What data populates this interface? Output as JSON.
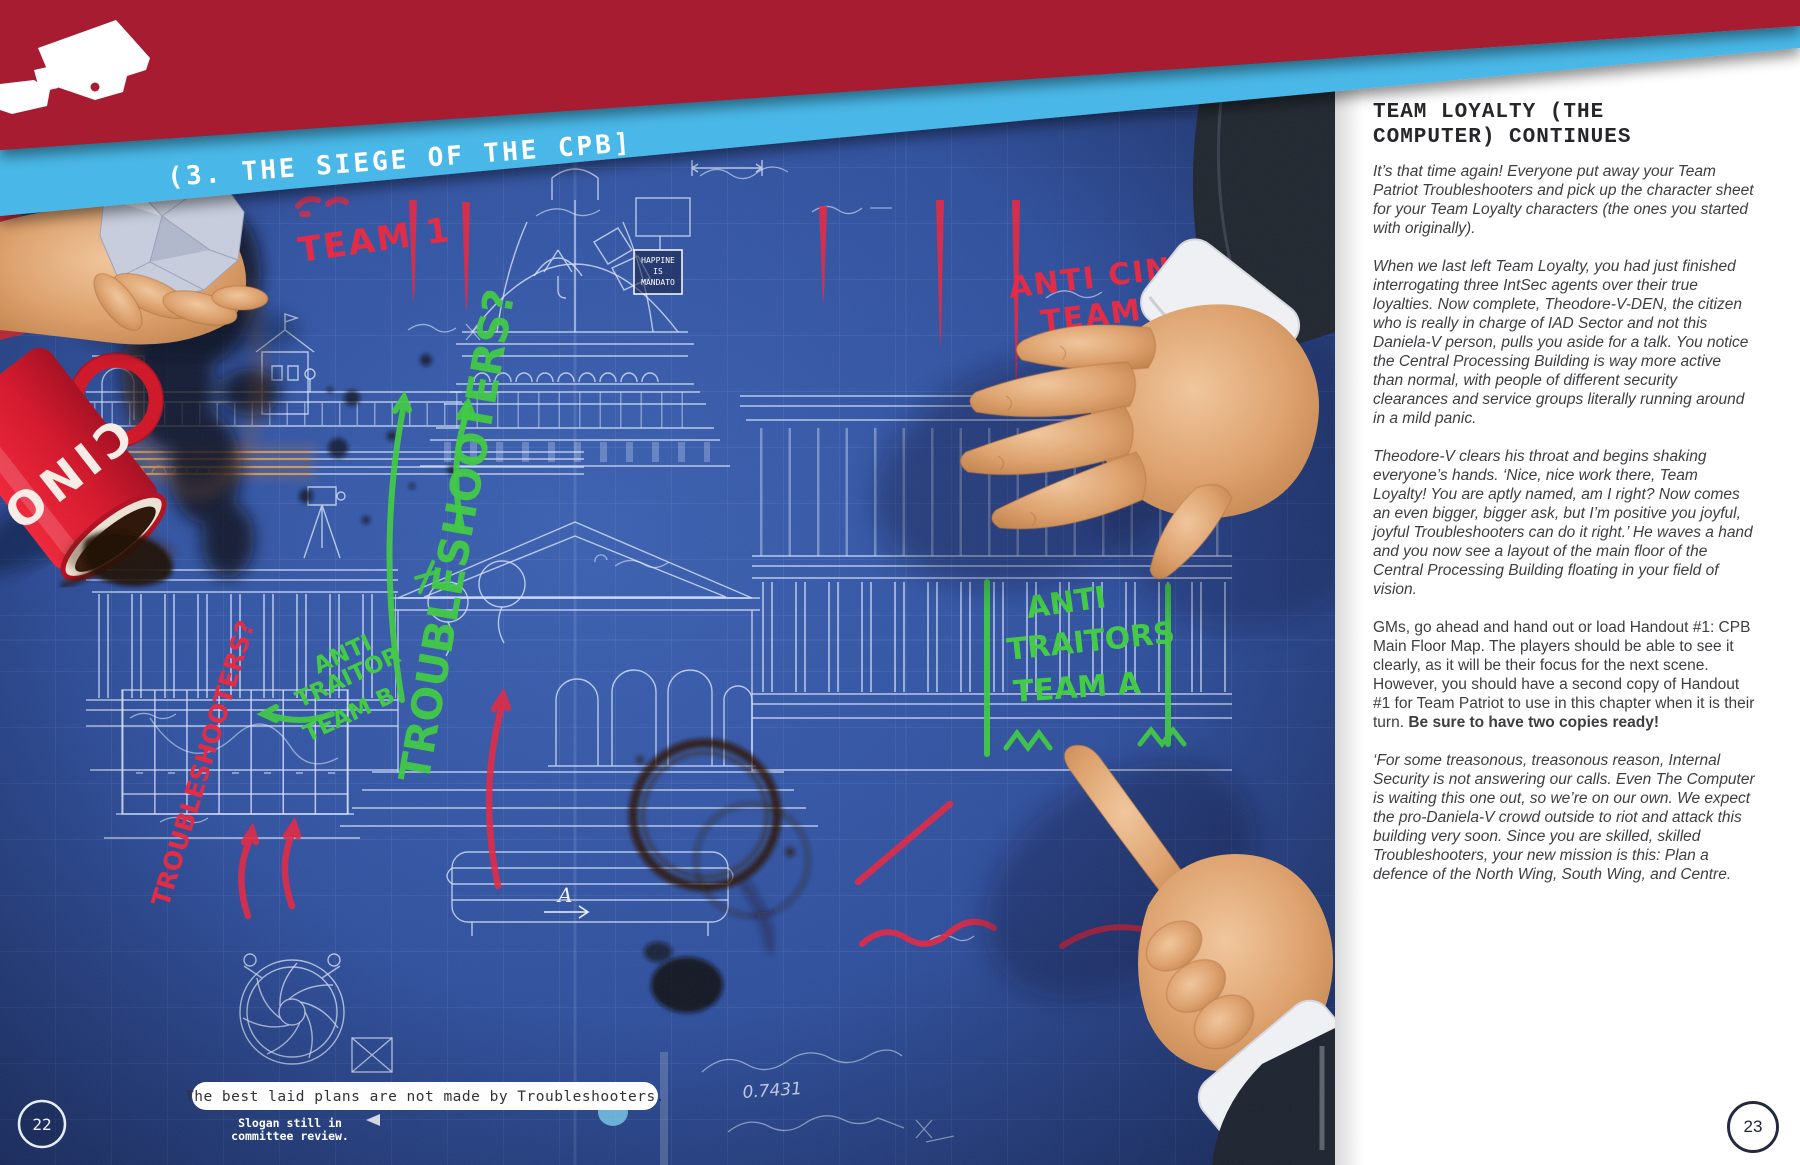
{
  "banner": {
    "camera_icon": "cctv-camera-icon",
    "title": "(3. THE SIEGE OF THE CPB]"
  },
  "blueprint": {
    "page_number": "22",
    "caption": "The best laid plans are not made by Troubleshooters.",
    "caption_note_line1": "Slogan still in",
    "caption_note_line2": "committee review.",
    "mug_text": "CINO",
    "measurement": "0.7431",
    "section_marker": "A",
    "sign": {
      "line1": "HAPPINE",
      "line2": "IS",
      "line3": "MANDATO"
    },
    "annotations": {
      "red": {
        "team1": "TEAM 1",
        "anti_cino_line1": "ANTI CINO",
        "anti_cino_line2": "TEAM 2",
        "troubleshooters": "TROUBLESHOOTERS?"
      },
      "green": {
        "troubleshooters": "TROUBLESHOOTERS?",
        "anti_traitor_b_line1": "ANTI",
        "anti_traitor_b_line2": "TRAITOR",
        "anti_traitor_b_line3": "TEAM B",
        "anti_traitors_a_line1": "ANTI",
        "anti_traitors_a_line2": "TRAITORS",
        "anti_traitors_a_line3": "TEAM A"
      }
    }
  },
  "right_page": {
    "page_number": "23",
    "heading_line1": "TEAM LOYALTY (THE",
    "heading_line2": "COMPUTER) CONTINUES",
    "paragraphs": [
      {
        "text": "It’s that time again! Everyone put away your Team Patriot Troubleshooters and pick up the character sheet for your Team Loyalty characters (the ones you started with originally)."
      },
      {
        "text": "When we last left Team Loyalty, you had just finished interrogating three IntSec agents over their true loyalties. Now complete, Theodore-V-DEN, the citizen who is really in charge of IAD Sector and not this Daniela-V person, pulls you aside for a talk. You notice the Central Processing Building is way more active than normal, with people of different security clearances and service groups literally running around in a mild panic."
      },
      {
        "text": "Theodore-V clears his throat and begins shaking everyone’s hands. ‘Nice, nice work there, Team Loyalty! You are aptly named, am I right? Now comes an even bigger, bigger ask, but I’m positive you joyful, joyful Troubleshooters can do it right.’ He waves a hand and you now see a layout of the main floor of the Central Processing Building floating in your field of vision."
      },
      {
        "text": "GMs, go ahead and hand out or load Handout #1: CPB Main Floor Map. The players should be able to see it clearly, as it will be their focus for the next scene. However, you should have a second copy of Handout #1 for Team Patriot to use in this chapter when it is their turn. ",
        "bold": "Be sure to have two copies ready!"
      },
      {
        "text": "‘For some treasonous, treasonous reason, Internal Security is not answering our calls. Even The Computer is waiting this one out, so we’re on our own. We expect the pro-Daniela-V crowd outside to riot and attack this building very soon. Since you are skilled, skilled Troubleshooters, your new mission is this: Plan a defence of the North Wing, South Wing, and Centre."
      }
    ]
  },
  "colors": {
    "banner_red": "#a81e31",
    "stripe_blue": "#49b8e8",
    "blueprint_blue": "#31519f",
    "marker_red": "#e32742",
    "marker_green": "#3fca42"
  }
}
